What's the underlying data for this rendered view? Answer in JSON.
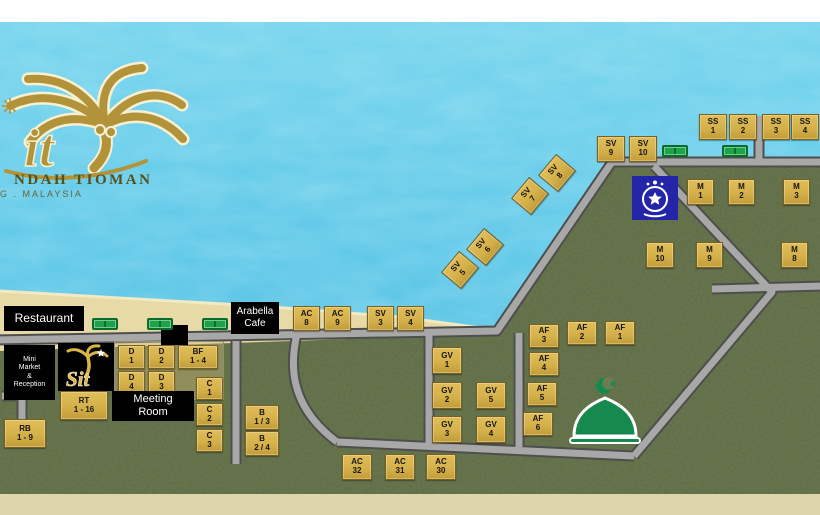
{
  "palette": {
    "water": "#53c3e6",
    "water_light": "#bfeef8",
    "sand": "#e8daa7",
    "sand_edge": "#f4ecc9",
    "grass": "#6e7c52",
    "grass_dark": "#39442c",
    "road": "#a8a8a8",
    "road_edge": "#4e4e4e",
    "strip_top": "#ffffff",
    "strip_bottom": "#ded6ab",
    "marker_bg": "#d5b14b",
    "marker_border": "#7a5f1d",
    "marker_text": "#141414",
    "label_bg": "#000000",
    "label_text": "#ffffff",
    "table_green": "#1da348",
    "police_blue": "#2424a8",
    "mosque_green": "#168a4e",
    "logo_gold": "#b29339",
    "logo_text_dark": "#55511c"
  },
  "logo": {
    "letters": "it",
    "line1": "NDAH TIOMAN",
    "line2": "G . MALAYSIA"
  },
  "sit_badge": {
    "text": "Sit"
  },
  "labels": [
    {
      "id": "restaurant-label",
      "text": "Restaurant",
      "x": 4,
      "y": 306,
      "w": 80,
      "h": 25,
      "fs": 12
    },
    {
      "id": "arabella-cafe-label",
      "text": "Arabella\nCafe",
      "x": 231,
      "y": 302,
      "w": 48,
      "h": 32,
      "fs": 10
    },
    {
      "id": "mini-market-reception-label",
      "text": "Mini\nMarket\n&\nReception",
      "x": 4,
      "y": 345,
      "w": 51,
      "h": 55,
      "fs": 7
    },
    {
      "id": "meeting-room-label",
      "text": "Meeting\nRoom",
      "x": 112,
      "y": 391,
      "w": 82,
      "h": 30,
      "fs": 11
    }
  ],
  "markers": [
    {
      "l1": "SS",
      "l2": "1",
      "x": 699,
      "y": 114,
      "w": 28,
      "h": 26
    },
    {
      "l1": "SS",
      "l2": "2",
      "x": 729,
      "y": 114,
      "w": 28,
      "h": 26
    },
    {
      "l1": "SS",
      "l2": "3",
      "x": 762,
      "y": 114,
      "w": 28,
      "h": 26
    },
    {
      "l1": "SS",
      "l2": "4",
      "x": 791,
      "y": 114,
      "w": 28,
      "h": 26
    },
    {
      "l1": "SV",
      "l2": "9",
      "x": 597,
      "y": 136,
      "w": 28,
      "h": 26
    },
    {
      "l1": "SV",
      "l2": "10",
      "x": 629,
      "y": 136,
      "w": 28,
      "h": 26
    },
    {
      "l1": "M",
      "l2": "1",
      "x": 687,
      "y": 179,
      "w": 27,
      "h": 26
    },
    {
      "l1": "M",
      "l2": "2",
      "x": 728,
      "y": 179,
      "w": 27,
      "h": 26
    },
    {
      "l1": "M",
      "l2": "3",
      "x": 783,
      "y": 179,
      "w": 27,
      "h": 26
    },
    {
      "l1": "M",
      "l2": "10",
      "x": 646,
      "y": 242,
      "w": 28,
      "h": 26
    },
    {
      "l1": "M",
      "l2": "9",
      "x": 696,
      "y": 242,
      "w": 27,
      "h": 26
    },
    {
      "l1": "M",
      "l2": "8",
      "x": 781,
      "y": 242,
      "w": 27,
      "h": 26
    },
    {
      "l1": "SV",
      "l2": "8",
      "x": 543,
      "y": 160,
      "w": 28,
      "h": 26,
      "rot": -50
    },
    {
      "l1": "SV",
      "l2": "7",
      "x": 516,
      "y": 183,
      "w": 28,
      "h": 26,
      "rot": -50
    },
    {
      "l1": "SV",
      "l2": "6",
      "x": 471,
      "y": 234,
      "w": 28,
      "h": 26,
      "rot": -50
    },
    {
      "l1": "SV",
      "l2": "5",
      "x": 446,
      "y": 257,
      "w": 28,
      "h": 26,
      "rot": -50
    },
    {
      "l1": "AC",
      "l2": "8",
      "x": 293,
      "y": 306,
      "w": 27,
      "h": 25
    },
    {
      "l1": "AC",
      "l2": "9",
      "x": 324,
      "y": 306,
      "w": 27,
      "h": 25
    },
    {
      "l1": "SV",
      "l2": "3",
      "x": 367,
      "y": 306,
      "w": 27,
      "h": 25
    },
    {
      "l1": "SV",
      "l2": "4",
      "x": 397,
      "y": 306,
      "w": 27,
      "h": 25
    },
    {
      "l1": "GV",
      "l2": "1",
      "x": 432,
      "y": 347,
      "w": 30,
      "h": 27
    },
    {
      "l1": "GV",
      "l2": "2",
      "x": 432,
      "y": 382,
      "w": 30,
      "h": 27
    },
    {
      "l1": "GV",
      "l2": "5",
      "x": 476,
      "y": 382,
      "w": 30,
      "h": 27
    },
    {
      "l1": "GV",
      "l2": "3",
      "x": 432,
      "y": 416,
      "w": 30,
      "h": 27
    },
    {
      "l1": "GV",
      "l2": "4",
      "x": 476,
      "y": 416,
      "w": 30,
      "h": 27
    },
    {
      "l1": "AF",
      "l2": "3",
      "x": 529,
      "y": 324,
      "w": 30,
      "h": 24
    },
    {
      "l1": "AF",
      "l2": "2",
      "x": 567,
      "y": 321,
      "w": 30,
      "h": 24
    },
    {
      "l1": "AF",
      "l2": "1",
      "x": 605,
      "y": 321,
      "w": 30,
      "h": 24
    },
    {
      "l1": "AF",
      "l2": "4",
      "x": 529,
      "y": 352,
      "w": 30,
      "h": 24
    },
    {
      "l1": "AF",
      "l2": "5",
      "x": 527,
      "y": 382,
      "w": 30,
      "h": 24
    },
    {
      "l1": "AF",
      "l2": "6",
      "x": 523,
      "y": 412,
      "w": 30,
      "h": 24
    },
    {
      "l1": "AC",
      "l2": "32",
      "x": 342,
      "y": 454,
      "w": 30,
      "h": 26
    },
    {
      "l1": "AC",
      "l2": "31",
      "x": 385,
      "y": 454,
      "w": 30,
      "h": 26
    },
    {
      "l1": "AC",
      "l2": "30",
      "x": 426,
      "y": 454,
      "w": 30,
      "h": 26
    },
    {
      "l1": "D",
      "l2": "1",
      "x": 118,
      "y": 345,
      "w": 27,
      "h": 24
    },
    {
      "l1": "D",
      "l2": "2",
      "x": 148,
      "y": 345,
      "w": 27,
      "h": 24
    },
    {
      "l1": "BF",
      "l2": "1 - 4",
      "x": 178,
      "y": 345,
      "w": 40,
      "h": 24
    },
    {
      "l1": "D",
      "l2": "4",
      "x": 118,
      "y": 371,
      "w": 27,
      "h": 24
    },
    {
      "l1": "D",
      "l2": "3",
      "x": 148,
      "y": 371,
      "w": 27,
      "h": 24
    },
    {
      "l1": "RT",
      "l2": "1 - 16",
      "x": 60,
      "y": 391,
      "w": 48,
      "h": 29
    },
    {
      "l1": "RB",
      "l2": "1 - 9",
      "x": 4,
      "y": 419,
      "w": 42,
      "h": 29
    },
    {
      "l1": "C",
      "l2": "1",
      "x": 196,
      "y": 377,
      "w": 27,
      "h": 23
    },
    {
      "l1": "C",
      "l2": "2",
      "x": 196,
      "y": 403,
      "w": 27,
      "h": 23
    },
    {
      "l1": "C",
      "l2": "3",
      "x": 196,
      "y": 429,
      "w": 27,
      "h": 23
    },
    {
      "l1": "B",
      "l2": "1 / 3",
      "x": 245,
      "y": 405,
      "w": 34,
      "h": 25
    },
    {
      "l1": "B",
      "l2": "2 / 4",
      "x": 245,
      "y": 431,
      "w": 34,
      "h": 25
    }
  ],
  "tables": [
    {
      "x": 92,
      "y": 318
    },
    {
      "x": 147,
      "y": 318
    },
    {
      "x": 202,
      "y": 318
    },
    {
      "x": 662,
      "y": 145
    },
    {
      "x": 722,
      "y": 145
    }
  ]
}
